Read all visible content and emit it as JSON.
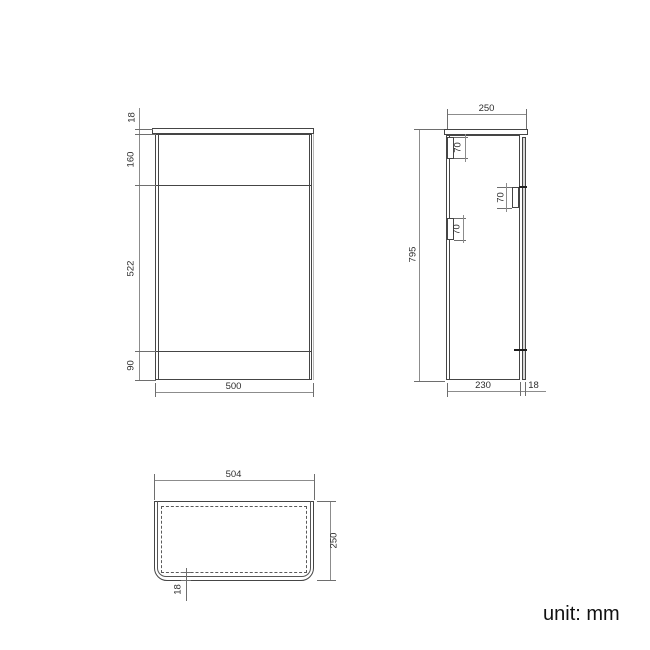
{
  "unit_label": "unit: mm",
  "front_view": {
    "top_thickness": "18",
    "upper_section": "160",
    "middle_section": "522",
    "bottom_section": "90",
    "width": "500"
  },
  "side_view": {
    "depth": "250",
    "height": "795",
    "body_depth": "230",
    "door_thickness": "18",
    "bracket_top_left": "70",
    "bracket_right": "70",
    "bracket_bottom_left": "70"
  },
  "top_view": {
    "width": "504",
    "depth": "250",
    "edge_offset": "18"
  }
}
